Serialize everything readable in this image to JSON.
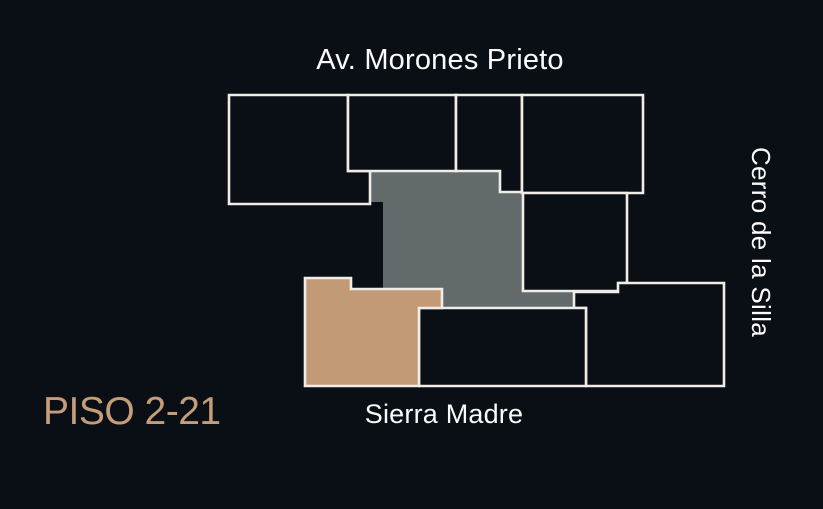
{
  "floor_plan": {
    "title": "PISO 2-21",
    "streets": {
      "top": "Av. Morones Prieto",
      "right": "Cerro de la Silla",
      "bottom": "Sierra Madre"
    }
  },
  "colors": {
    "bg": "#0a0e15",
    "accent": "#c59d79",
    "selected": "#c29a76",
    "core": "#636a6c",
    "outline": "#f0ede7",
    "label": "#fbfbfb"
  }
}
